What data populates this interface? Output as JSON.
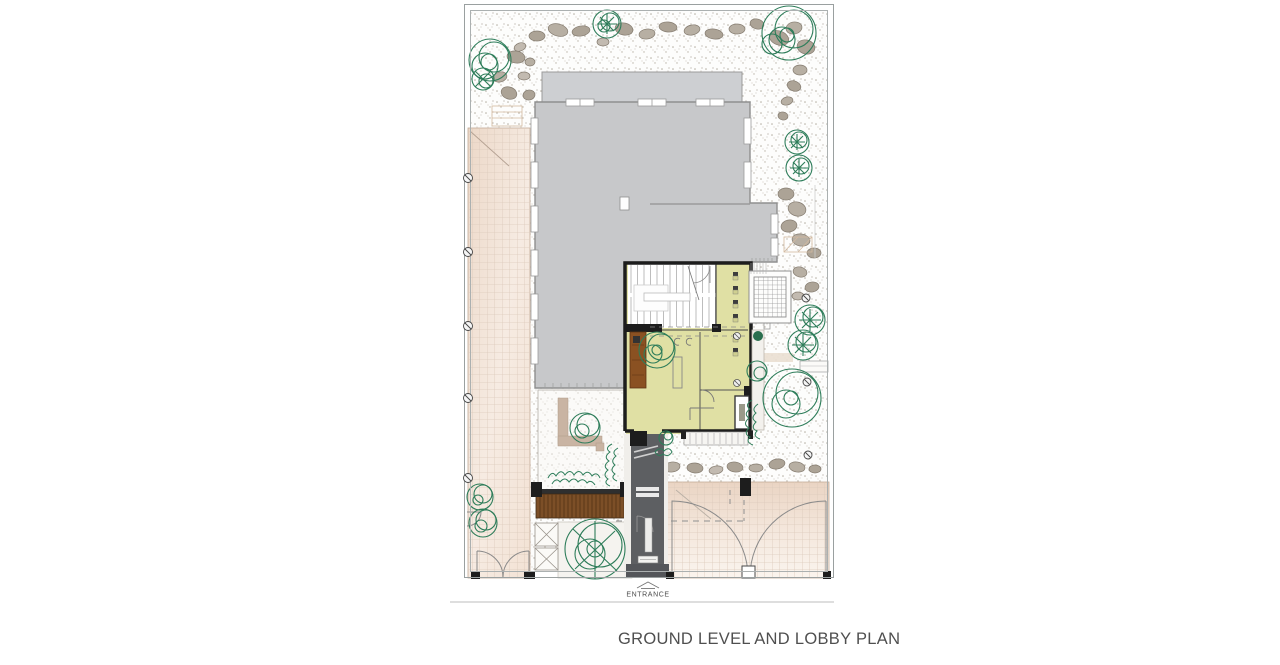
{
  "caption": {
    "text": "GROUND LEVEL AND LOBBY PLAN"
  },
  "annotations": {
    "entrance_label": "ENTRANCE"
  },
  "features": [
    "site-boundary",
    "gravel-ground-with-stipple",
    "rock-stepping-stones",
    "main-building-mass",
    "upper-roof-block",
    "lobby-with-stair",
    "lobby-corridor-doors",
    "wood-bench",
    "fireplace",
    "trellis-pergola",
    "garden-court",
    "wood-deck",
    "planters",
    "entrance-walkway",
    "left-paved-drive",
    "right-paved-drive",
    "gate-swings",
    "trees",
    "hedges"
  ],
  "colors": {
    "background": "#ffffff",
    "building_gray": "#c7c8ca",
    "building_gray_light": "#cdcfd2",
    "lobby_floor_yellow": "#e0e0a4",
    "wall_black": "#1d1d1d",
    "walkway_dark_gray": "#5d5f62",
    "wood_brown": "#8a5122",
    "paving_pink": "#eedbcd",
    "tan_wall": "#c9b4a3",
    "tree_green": "#2e7d5a",
    "rock_gray": "#aca396",
    "stipple_gray": "#b3aca1",
    "title_text": "#4f4f4f",
    "divider": "#cbcbcb"
  }
}
